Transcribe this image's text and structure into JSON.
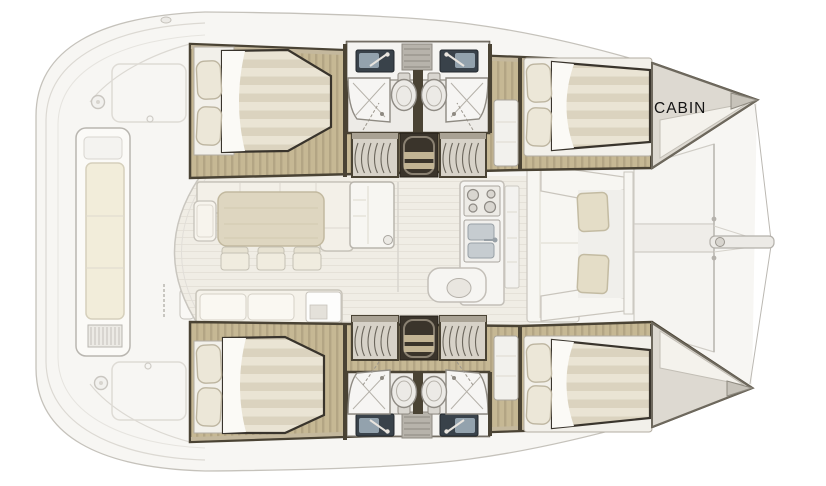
{
  "labels": {
    "port_bow_cabin": "CABIN"
  },
  "palette": {
    "deck": "#f7f6f3",
    "deck_outline": "#c5c2bb",
    "deck_line": "#dcd9d3",
    "salon_floor": "#f0ede5",
    "plank_line": "#e5e1d8",
    "wood": "#c6b894",
    "wood_grain": "#b3a584",
    "wall": "#4a4334",
    "wall_tan": "#c4b89d",
    "mattress_a": "#eae4d4",
    "mattress_b": "#dbd3bf",
    "bed_outline": "#39342c",
    "pillow": "#ece7d8",
    "pillow_outline": "#bdb5a0",
    "white_fixture": "#f5f4f1",
    "fixture_outline": "#8f8b84",
    "bath_floor": "#edebe7",
    "sink_dark": "#39424a",
    "sink_steel": "#93a2ad",
    "stair_tread": "#d7d2c8",
    "stair_line": "#6b665c",
    "hatch_dark": "#3a342b",
    "sofa": "#f3f0e8",
    "sofa_outline": "#c8c4ba",
    "table": "#ded6c0",
    "table_outline": "#c2b99f",
    "chair": "#f0ecdf",
    "cushion": "#f2edda",
    "cushion_outline": "#d6d0bc",
    "seat_beige": "#e4ddc7",
    "cone": "#ddd9d1",
    "cone_tip": "#c7c3ba",
    "label_text": "#141414",
    "bg": "#ffffff"
  }
}
